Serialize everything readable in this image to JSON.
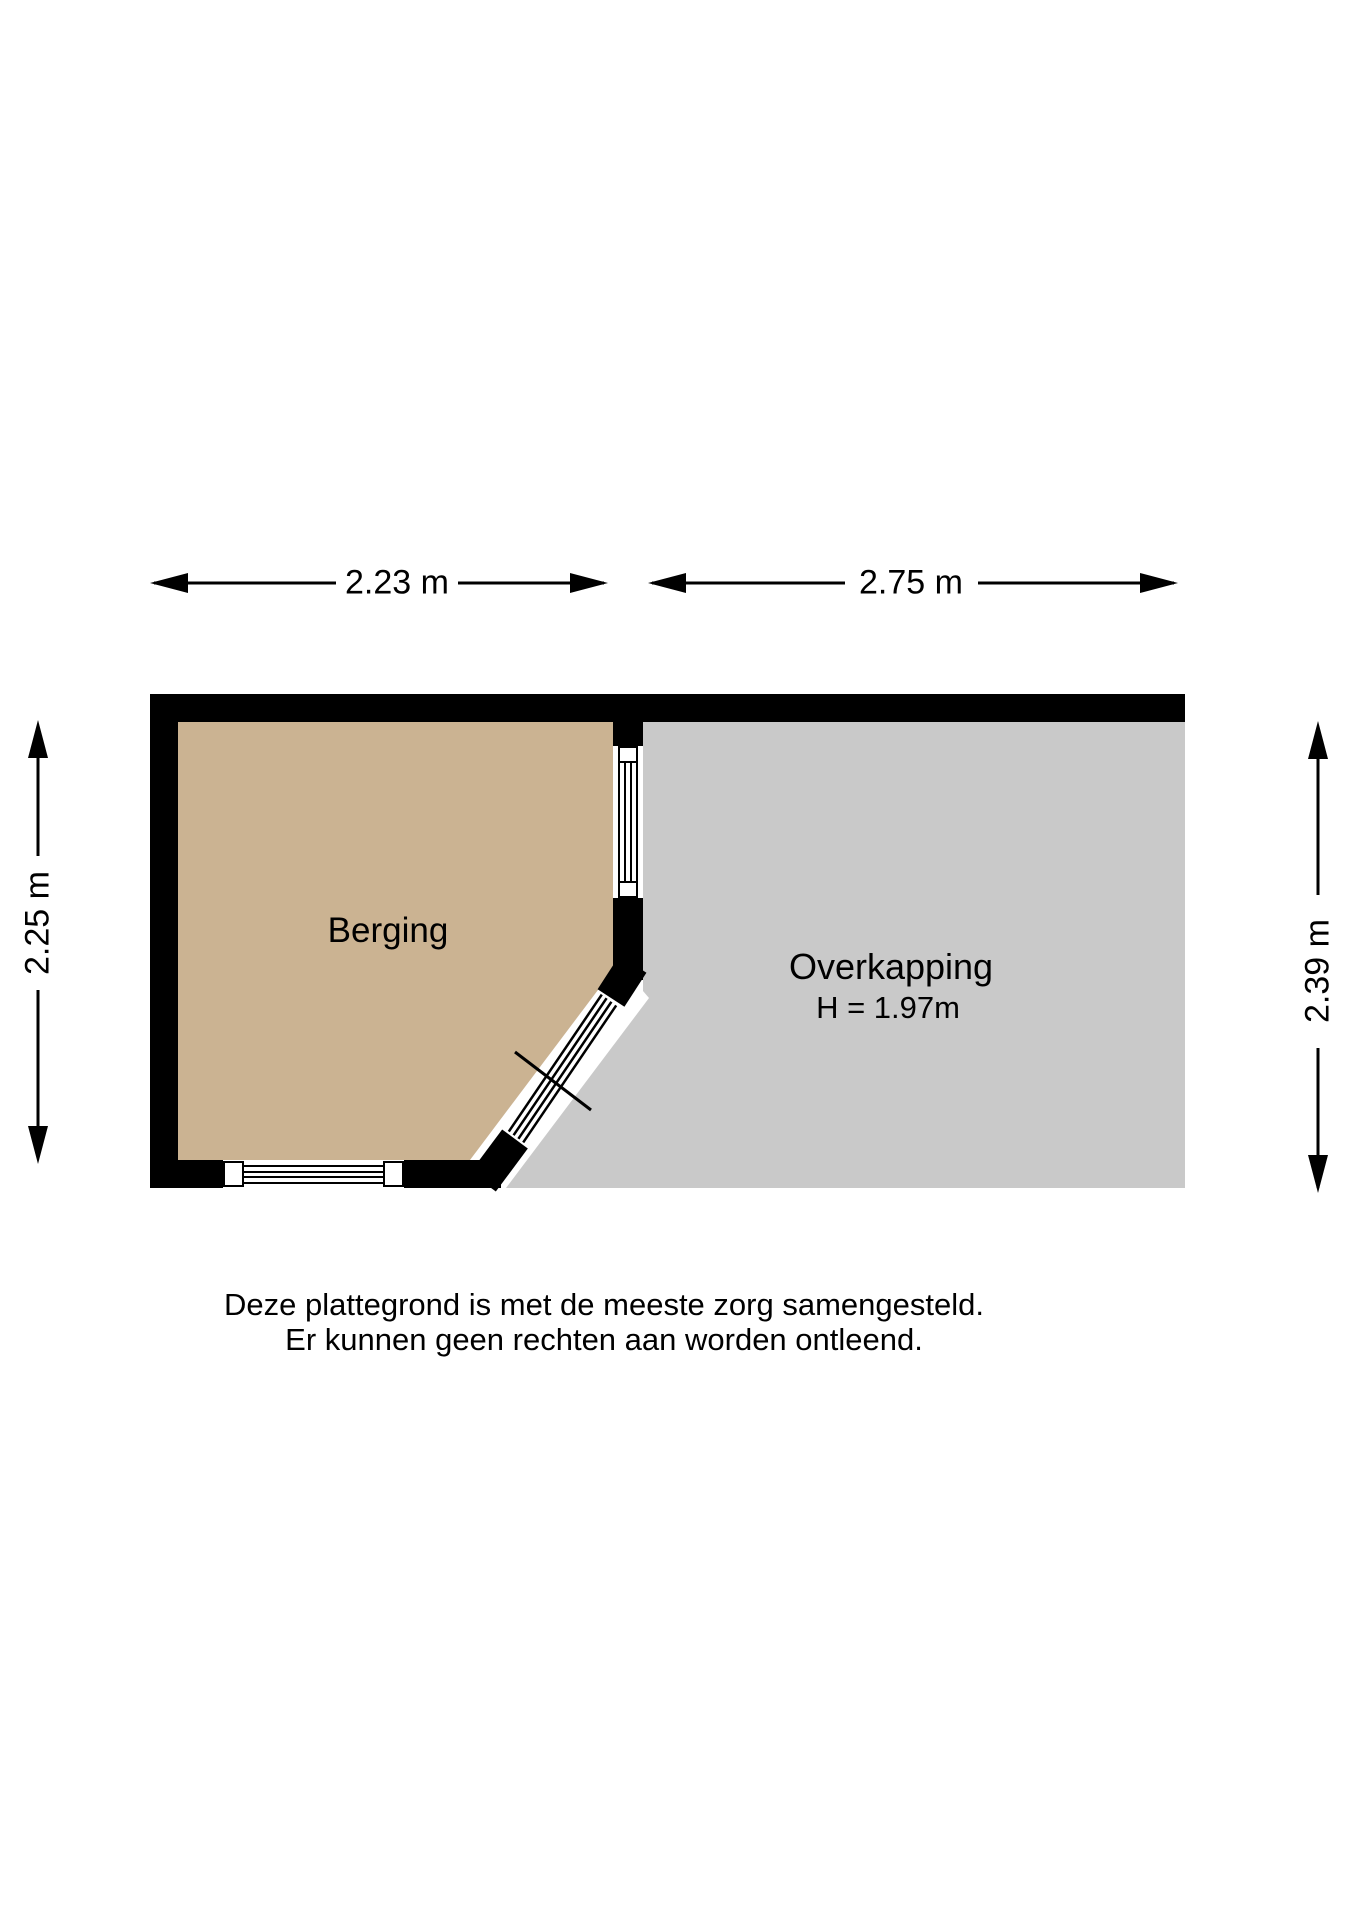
{
  "plan": {
    "title": "plattegrond",
    "rooms": {
      "berging": {
        "label": "Berging"
      },
      "overkapping": {
        "label": "Overkapping",
        "height_note": "H = 1.97m"
      }
    },
    "dimensions": {
      "berging_width": "2.23 m",
      "overkapping_width": "2.75 m",
      "berging_height": "2.25 m",
      "overkapping_height": "2.39 m"
    },
    "colors": {
      "berging_fill": "#cbb392",
      "overkapping_fill": "#c9c9c9",
      "wall": "#000000",
      "line": "#000000",
      "window_fill": "#ffffff"
    }
  },
  "disclaimer": {
    "line1": "Deze plattegrond is met de meeste zorg samengesteld.",
    "line2": "Er kunnen geen rechten aan worden ontleend."
  }
}
